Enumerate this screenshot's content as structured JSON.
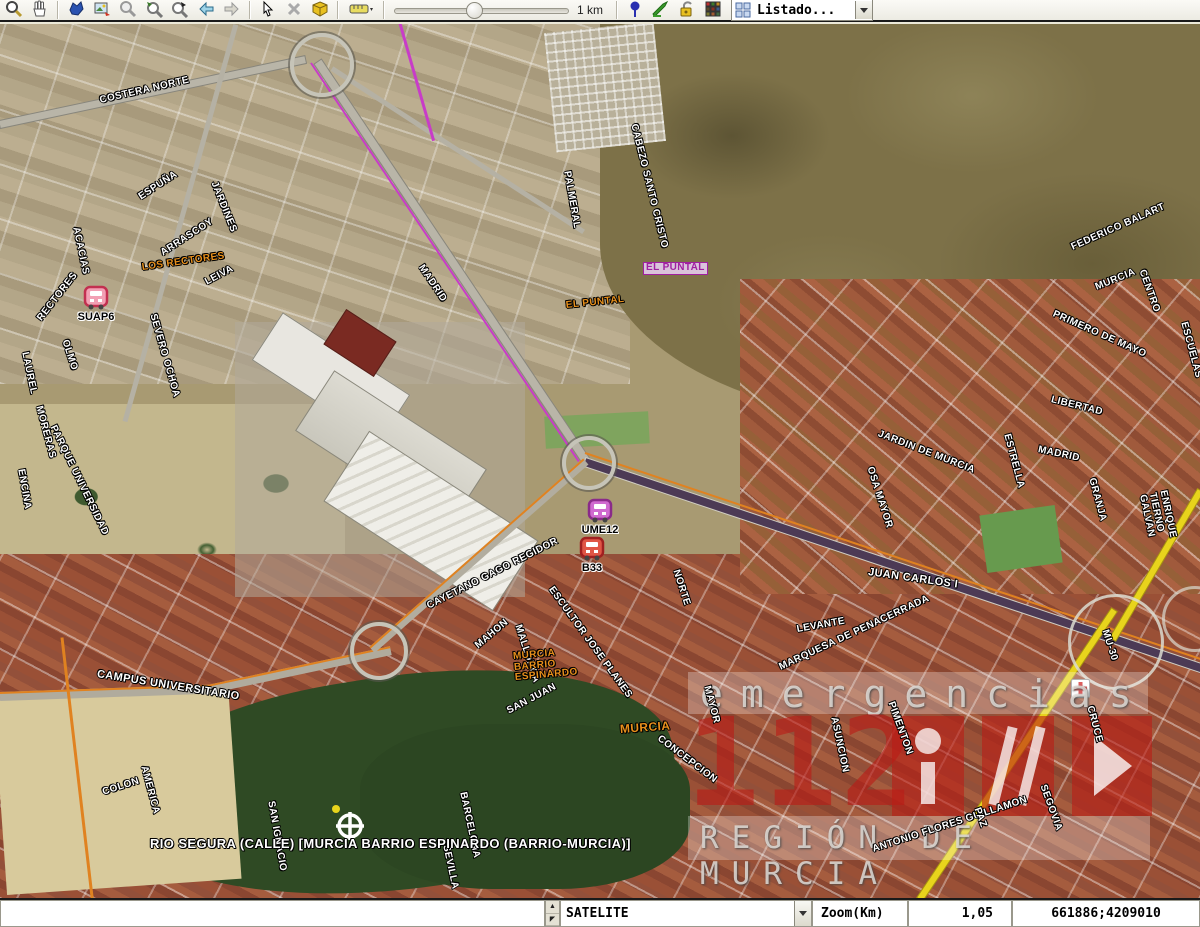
{
  "toolbar": {
    "icons": [
      "zoom",
      "pan",
      "overview",
      "snapshot",
      "zoom-previous",
      "zoom-window",
      "zoom-select",
      "back",
      "forward",
      "pointer",
      "clear-selection",
      "view-3d",
      "measure",
      "pushpin",
      "draw",
      "lock",
      "legend"
    ],
    "scale_label": "1 km",
    "listado": {
      "label": "Listado..."
    }
  },
  "map": {
    "watermark": {
      "top": "emergencias",
      "number": "112",
      "bottom": "REGIÓN DE MURCIA"
    },
    "labels": [
      {
        "t": "COSTERA NORTE",
        "x": 100,
        "y": 97,
        "r": -13,
        "c": "st"
      },
      {
        "t": "ACACIAS",
        "x": 75,
        "y": 223,
        "r": 78,
        "c": "st"
      },
      {
        "t": "ESPUÑA",
        "x": 140,
        "y": 194,
        "r": -33,
        "c": "st"
      },
      {
        "t": "JARDINES",
        "x": 213,
        "y": 178,
        "r": 68,
        "c": "st"
      },
      {
        "t": "ARRASCOY",
        "x": 162,
        "y": 250,
        "r": -33,
        "c": "st"
      },
      {
        "t": "LOS RECTORES",
        "x": 142,
        "y": 264,
        "r": -8,
        "c": "or"
      },
      {
        "t": "LEIVA",
        "x": 206,
        "y": 279,
        "r": -28,
        "c": "st"
      },
      {
        "t": "RECTORES",
        "x": 40,
        "y": 316,
        "r": -52,
        "c": "st"
      },
      {
        "t": "SEVERO OCHOA",
        "x": 152,
        "y": 310,
        "r": 74,
        "c": "st"
      },
      {
        "t": "LAUREL",
        "x": 24,
        "y": 348,
        "r": 78,
        "c": "st"
      },
      {
        "t": "OLMO",
        "x": 64,
        "y": 336,
        "r": 72,
        "c": "st"
      },
      {
        "t": "MORERAS",
        "x": 38,
        "y": 402,
        "r": 75,
        "c": "st"
      },
      {
        "t": "PARQUE UNIVERSIDAD",
        "x": 52,
        "y": 422,
        "r": 64,
        "c": "st"
      },
      {
        "t": "ENCINA",
        "x": 20,
        "y": 465,
        "r": 80,
        "c": "st"
      },
      {
        "t": "MADRID",
        "x": 420,
        "y": 262,
        "r": 56,
        "c": "st"
      },
      {
        "t": "PALMERAL",
        "x": 566,
        "y": 167,
        "r": 80,
        "c": "st"
      },
      {
        "t": "CABEZO SANTO CRISTO",
        "x": 633,
        "y": 120,
        "r": 76,
        "c": "st"
      },
      {
        "t": "EL PUNTAL",
        "x": 643,
        "y": 263,
        "r": 0,
        "c": "pur"
      },
      {
        "t": "EL PUNTAL",
        "x": 566,
        "y": 302,
        "r": -6,
        "c": "or"
      },
      {
        "t": "FEDERICO BALART",
        "x": 1072,
        "y": 244,
        "r": -24,
        "c": "st"
      },
      {
        "t": "MURCIA",
        "x": 1096,
        "y": 284,
        "r": -22,
        "c": "st"
      },
      {
        "t": "CENTRO",
        "x": 1141,
        "y": 266,
        "r": 70,
        "c": "st"
      },
      {
        "t": "ESCUELAS",
        "x": 1183,
        "y": 318,
        "r": 75,
        "c": "st"
      },
      {
        "t": "PRIMERO DE MAYO",
        "x": 1053,
        "y": 310,
        "r": 24,
        "c": "st"
      },
      {
        "t": "LIBERTAD",
        "x": 1051,
        "y": 396,
        "r": 14,
        "c": "st"
      },
      {
        "t": "JARDIN DE MURCIA",
        "x": 878,
        "y": 430,
        "r": 21,
        "c": "st"
      },
      {
        "t": "OSA MAYOR",
        "x": 869,
        "y": 463,
        "r": 72,
        "c": "st"
      },
      {
        "t": "ESTRELLA",
        "x": 1006,
        "y": 430,
        "r": 75,
        "c": "st"
      },
      {
        "t": "MADRID",
        "x": 1038,
        "y": 446,
        "r": 12,
        "c": "st"
      },
      {
        "t": "GRANJA",
        "x": 1091,
        "y": 474,
        "r": 75,
        "c": "st"
      },
      {
        "t": "JUAN CARLOS I",
        "x": 868,
        "y": 568,
        "r": 8,
        "c": "st",
        "s": 11
      },
      {
        "t": "ENRIQUE TIERNO GALVAN",
        "x": 1152,
        "y": 478,
        "r": 78,
        "c": "st"
      },
      {
        "t": "MU-30",
        "x": 1104,
        "y": 626,
        "r": 72,
        "c": "st"
      },
      {
        "t": "NORTE",
        "x": 675,
        "y": 566,
        "r": 72,
        "c": "st"
      },
      {
        "t": "LEVANTE",
        "x": 797,
        "y": 626,
        "r": -10,
        "c": "st"
      },
      {
        "t": "CAYETANO GAGO REGIDOR",
        "x": 428,
        "y": 603,
        "r": -27,
        "c": "st"
      },
      {
        "t": "MAHON",
        "x": 477,
        "y": 643,
        "r": -40,
        "c": "st"
      },
      {
        "t": "MALLORCA",
        "x": 517,
        "y": 621,
        "r": 72,
        "c": "st"
      },
      {
        "t": "ESCULTOR JOSE PLANES",
        "x": 550,
        "y": 584,
        "r": 54,
        "c": "st"
      },
      {
        "t": "SAN JUAN",
        "x": 508,
        "y": 708,
        "r": -28,
        "c": "st"
      },
      {
        "t": "MURCIA\nBARRIO\nESPINARDO",
        "x": 514,
        "y": 653,
        "r": -5,
        "c": "or"
      },
      {
        "t": "MURCIA",
        "x": 620,
        "y": 724,
        "r": -4,
        "c": "or",
        "s": 12
      },
      {
        "t": "CONCEPCION",
        "x": 658,
        "y": 734,
        "r": 37,
        "c": "st"
      },
      {
        "t": "CAMPUS UNIVERSITARIO",
        "x": 97,
        "y": 670,
        "r": 9,
        "c": "st",
        "s": 11
      },
      {
        "t": "COLON",
        "x": 103,
        "y": 789,
        "r": -18,
        "c": "st"
      },
      {
        "t": "AMERICA",
        "x": 143,
        "y": 762,
        "r": 75,
        "c": "st"
      },
      {
        "t": "SAN IGNACIO",
        "x": 270,
        "y": 797,
        "r": 80,
        "c": "st"
      },
      {
        "t": "BARCELONA",
        "x": 462,
        "y": 788,
        "r": 78,
        "c": "st"
      },
      {
        "t": "SEVILLA",
        "x": 445,
        "y": 841,
        "r": 78,
        "c": "st"
      },
      {
        "t": "MARQUESA DE PENACERRADA",
        "x": 780,
        "y": 664,
        "r": -25,
        "c": "st"
      },
      {
        "t": "MAYOR",
        "x": 706,
        "y": 682,
        "r": 75,
        "c": "st"
      },
      {
        "t": "ASUNCION",
        "x": 833,
        "y": 713,
        "r": 78,
        "c": "st"
      },
      {
        "t": "PIMENTON",
        "x": 890,
        "y": 698,
        "r": 70,
        "c": "st"
      },
      {
        "t": "ANTONIO FLORES GUILLAMON",
        "x": 873,
        "y": 846,
        "r": -18,
        "c": "st"
      },
      {
        "t": "SEGOVIA",
        "x": 1042,
        "y": 781,
        "r": 70,
        "c": "st"
      },
      {
        "t": "CRUCE",
        "x": 1089,
        "y": 702,
        "r": 75,
        "c": "st"
      },
      {
        "t": "PAZ",
        "x": 976,
        "y": 804,
        "r": 70,
        "c": "st"
      },
      {
        "t": "RIO SEGURA (CALLE) [MURCIA BARRIO ESPINARDO (BARRIO-MURCIA)]",
        "x": 150,
        "y": 838,
        "r": 0,
        "c": "res",
        "s": 13
      }
    ],
    "markers": [
      {
        "id": "SUAP6",
        "x": 96,
        "y": 298,
        "body": "#f2a0b4",
        "dark": "#c23050"
      },
      {
        "id": "UME12",
        "x": 600,
        "y": 511,
        "body": "#d06ad0",
        "dark": "#8a2a8a"
      },
      {
        "id": "B33",
        "x": 592,
        "y": 549,
        "body": "#e05545",
        "dark": "#a02020"
      }
    ]
  },
  "statusbar": {
    "left_value": "",
    "layer": "SATELITE",
    "zoom_label": "Zoom(Km)",
    "zoom_value": "1,05",
    "coordinates": "661886;4209010"
  }
}
